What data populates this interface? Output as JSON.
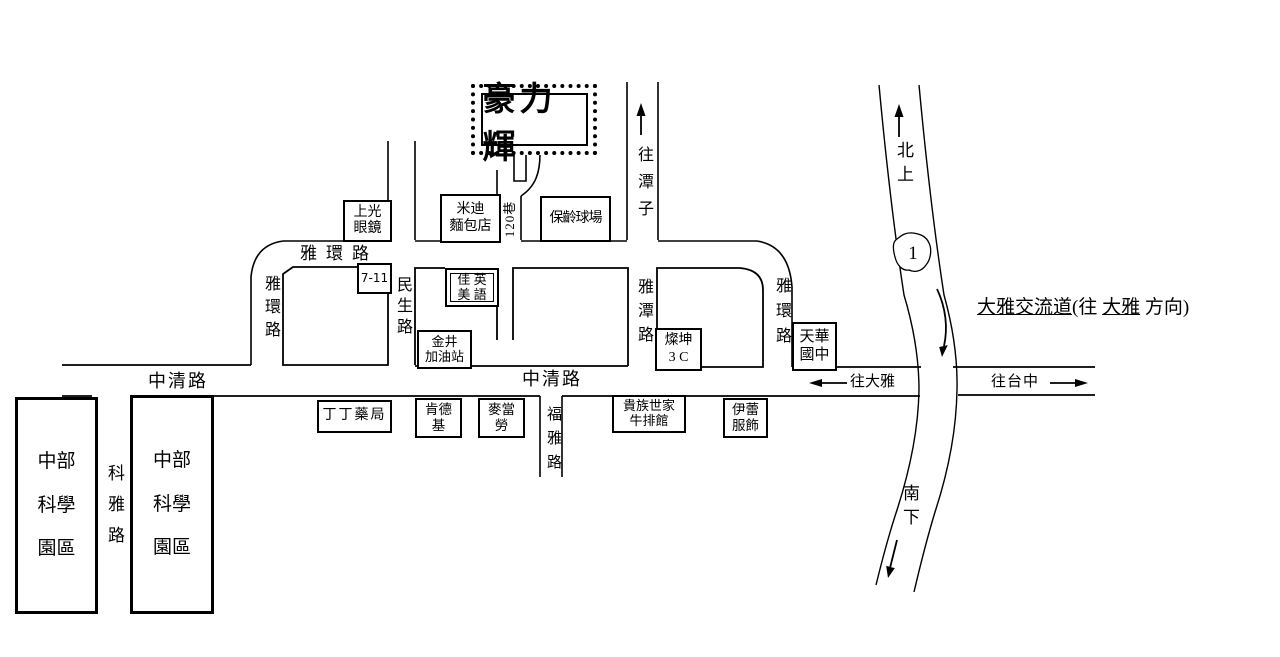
{
  "map": {
    "destination": {
      "name": "豪力輝"
    },
    "roads": {
      "yahuan_top": "雅環路",
      "yahuan_left": "雅環路",
      "yahuan_right": "雅環路",
      "minsheng": "民生路",
      "yatan": "雅潭路",
      "fuya": "福雅路",
      "keya": "科雅路",
      "zhongqing_left": "中清路",
      "zhongqing_right": "中清路",
      "lane120": "120巷"
    },
    "directions": {
      "to_tanzi": "往潭子",
      "northbound": "北上",
      "southbound": "南下",
      "to_daya": "往大雅",
      "to_taichung": "往台中",
      "interchange_main": "大雅交流道",
      "interchange_pre": "(往 ",
      "interchange_daya": "大雅",
      "interchange_post": " 方向)"
    },
    "highway": {
      "shield": "1"
    },
    "landmarks": {
      "shangguang": "上光\n眼鏡",
      "midi": "米迪\n麵包店",
      "bowling": "保齡球場",
      "seven11": "7-11",
      "jiamei": "佳 英\n美 語",
      "jinjing": "金井\n加油站",
      "tsannkuen": "燦坤\n3 C",
      "tianhua": "天華\n國中",
      "dingding": "丁丁藥局",
      "kfc": "肯德\n基",
      "mcdonalds": "麥當\n勞",
      "noble": "貴族世家\n牛排館",
      "yilei": "伊蕾\n服飾",
      "science_park_1": "中部\n科學\n園區",
      "science_park_2": "中部\n科學\n園區"
    }
  }
}
